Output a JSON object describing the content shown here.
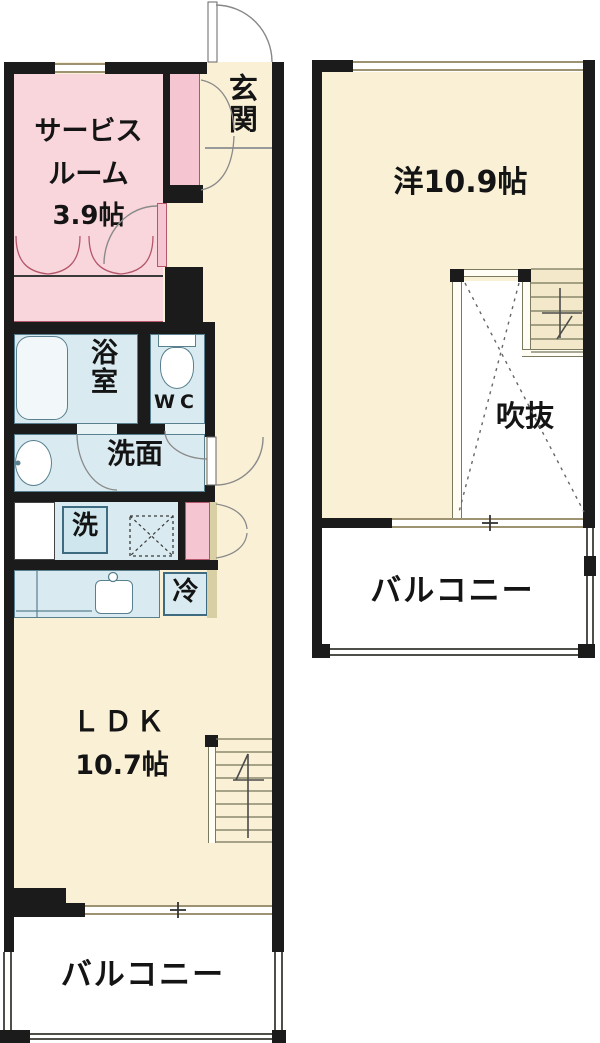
{
  "palette": {
    "wall": "#1b1b1b",
    "room_cream": "#faf0d6",
    "room_pink": "#f8d6dc",
    "door_pink": "#f5c6d2",
    "wet_area_blue": "#d9ebf1",
    "stair_tan": "#f3e8c9",
    "window_frame": "#9d9372",
    "void_white": "#ffffff"
  },
  "floor1": {
    "service_room": {
      "line1": "サービス",
      "line2": "ルーム",
      "line3": "3.9帖"
    },
    "entrance_label": "玄関",
    "bath_label": "浴室",
    "wc_label": "WC",
    "washroom_label": "洗面",
    "washer_label": "洗",
    "fridge_label": "冷",
    "ldk": {
      "line1": "ＬＤＫ",
      "line2": "10.7帖"
    },
    "balcony_label": "バルコニー"
  },
  "floor2": {
    "room_label": "洋10.9帖",
    "void_label": "吹抜",
    "balcony_label": "バルコニー"
  }
}
